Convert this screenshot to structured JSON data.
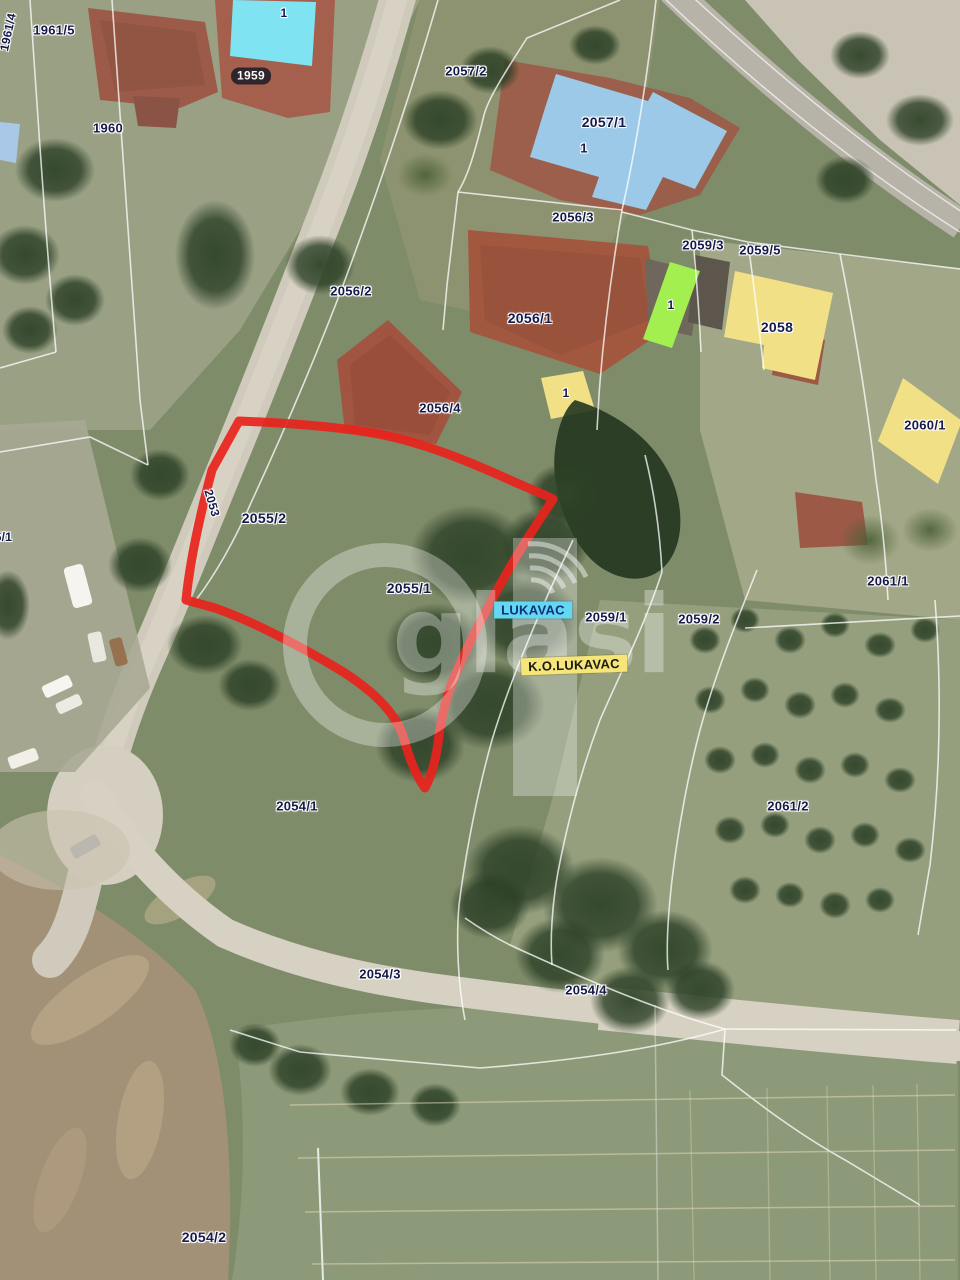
{
  "map": {
    "watermark": {
      "brand": "oglasi",
      "text_rest": "glasi"
    },
    "colors": {
      "outline_red": "#e8231c",
      "building_blue": "#9cc9e8",
      "building_cyan": "#7fe3f2",
      "building_yellow": "#f2e086",
      "building_green": "#a3ef4f",
      "building_lightblue": "#a9c7e6",
      "badge_cyan": "#63d8f0",
      "badge_yellow": "#f6e67a",
      "label_navy": "#151a4a"
    },
    "parcel_labels": [
      {
        "text": "1961/4",
        "x": 8,
        "y": 32,
        "rot": -78,
        "fs": 12
      },
      {
        "text": "1961/5",
        "x": 54,
        "y": 30
      },
      {
        "text": "1960",
        "x": 108,
        "y": 128
      },
      {
        "text": "2057/2",
        "x": 466,
        "y": 71
      },
      {
        "text": "2057/1",
        "x": 604,
        "y": 122,
        "fs": 14
      },
      {
        "text": "1",
        "x": 284,
        "y": 13,
        "fs": 12
      },
      {
        "text": "1",
        "x": 584,
        "y": 148,
        "fs": 13
      },
      {
        "text": "2056/3",
        "x": 573,
        "y": 217
      },
      {
        "text": "2059/3",
        "x": 703,
        "y": 245
      },
      {
        "text": "2059/5",
        "x": 760,
        "y": 250
      },
      {
        "text": "2056/2",
        "x": 351,
        "y": 291
      },
      {
        "text": "2056/1",
        "x": 530,
        "y": 318,
        "fs": 14
      },
      {
        "text": "1",
        "x": 671,
        "y": 305,
        "fs": 12
      },
      {
        "text": "2058",
        "x": 777,
        "y": 327,
        "fs": 14
      },
      {
        "text": "2060/1",
        "x": 925,
        "y": 425
      },
      {
        "text": "2056/4",
        "x": 440,
        "y": 408
      },
      {
        "text": "1",
        "x": 566,
        "y": 393,
        "fs": 12
      },
      {
        "text": "2055/2",
        "x": 264,
        "y": 518,
        "fs": 14
      },
      {
        "text": "2053",
        "x": 212,
        "y": 503,
        "rot": 74,
        "fs": 12
      },
      {
        "text": "05/1",
        "x": 0,
        "y": 537,
        "fs": 12
      },
      {
        "text": "2055/1",
        "x": 409,
        "y": 588,
        "fs": 14
      },
      {
        "text": "2059/1",
        "x": 606,
        "y": 617
      },
      {
        "text": "2059/2",
        "x": 699,
        "y": 619
      },
      {
        "text": "2061/1",
        "x": 888,
        "y": 581
      },
      {
        "text": "2061/2",
        "x": 788,
        "y": 806
      },
      {
        "text": "2054/1",
        "x": 297,
        "y": 806
      },
      {
        "text": "2054/3",
        "x": 380,
        "y": 974
      },
      {
        "text": "2054/4",
        "x": 586,
        "y": 990
      },
      {
        "text": "2054/2",
        "x": 204,
        "y": 1237,
        "fs": 14
      }
    ],
    "badges": [
      {
        "text": "1959",
        "x": 251,
        "y": 76,
        "cls": "pill"
      },
      {
        "text": "LUKAVAC",
        "x": 533,
        "y": 610,
        "cls": "badge-cyan",
        "bg": "badge_cyan"
      },
      {
        "text": "K.O.LUKAVAC",
        "x": 574,
        "y": 665,
        "cls": "badge-yellow",
        "bg": "badge_yellow",
        "rot": -2
      }
    ]
  }
}
